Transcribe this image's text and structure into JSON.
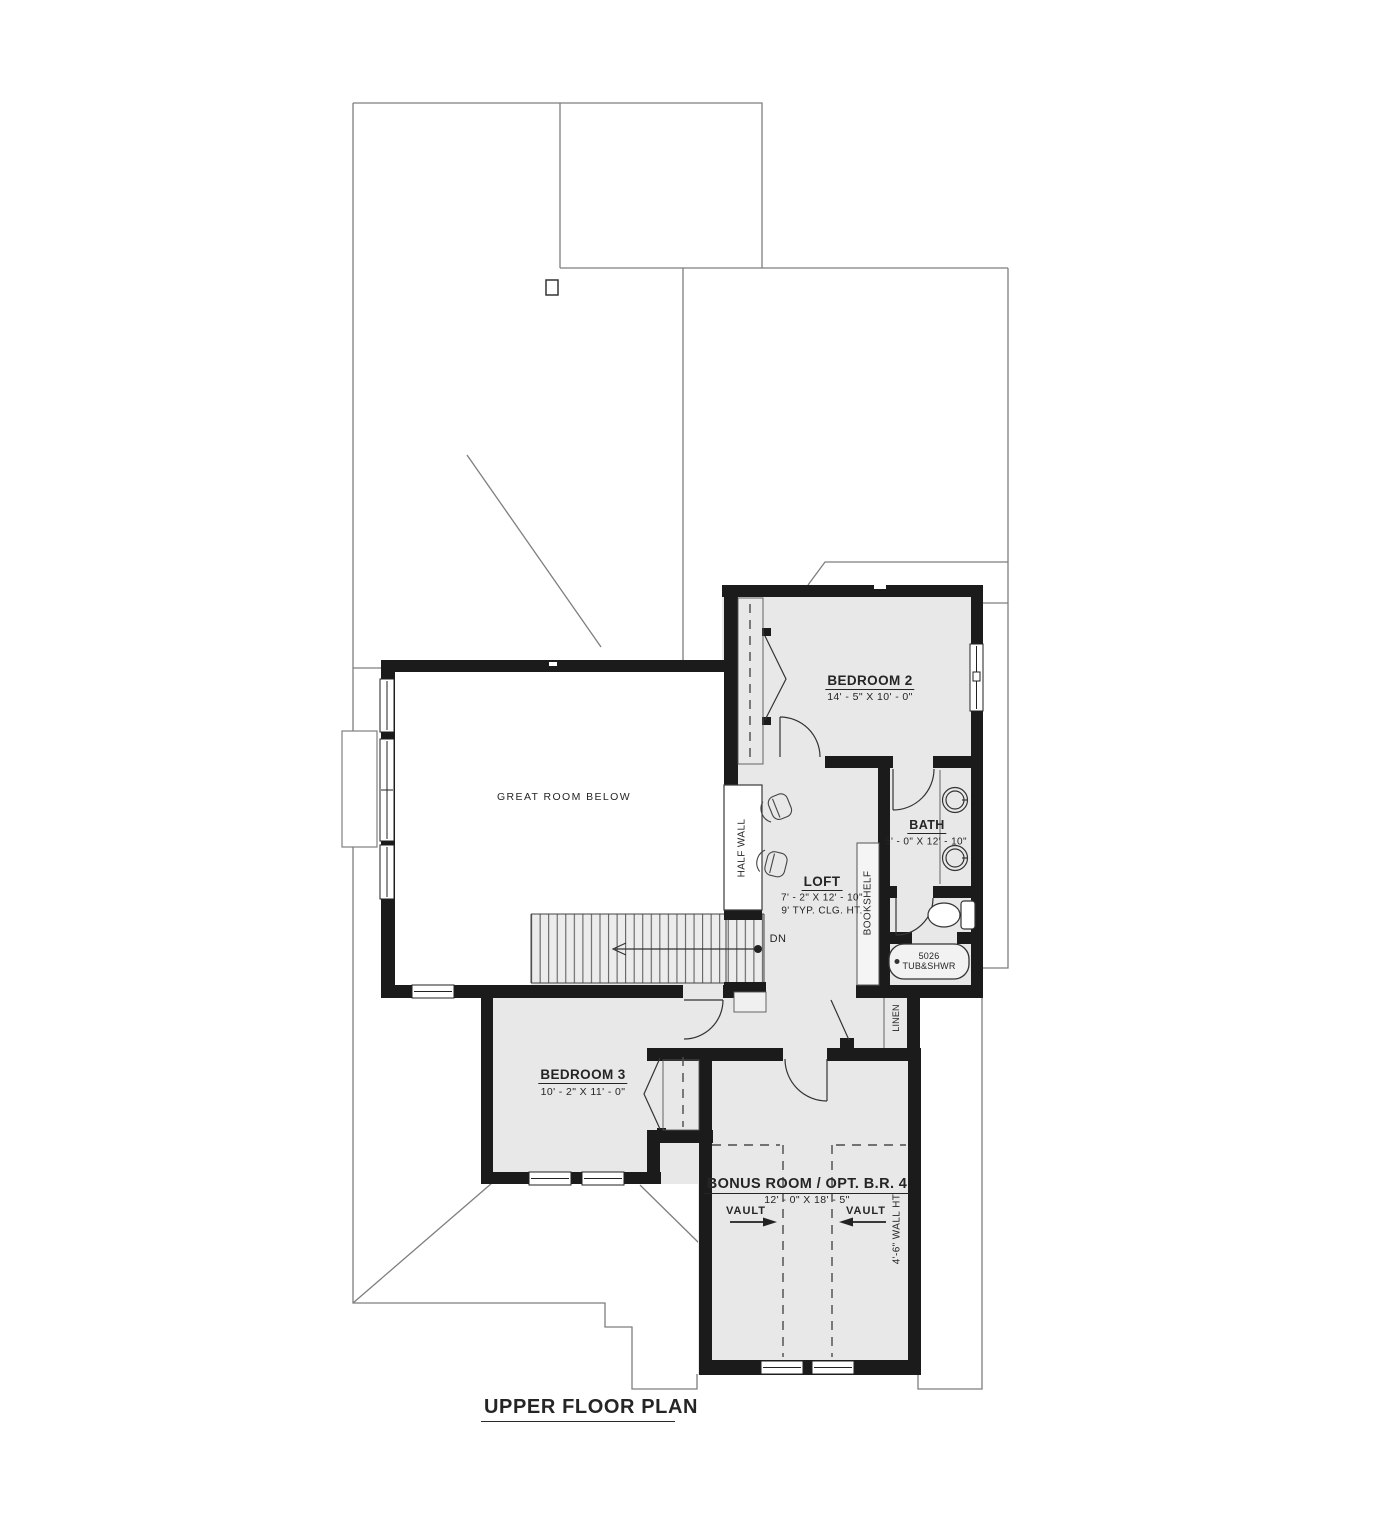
{
  "title": "UPPER FLOOR PLAN",
  "rooms": {
    "great_room": {
      "label": "GREAT ROOM BELOW"
    },
    "bedroom2": {
      "name": "BEDROOM 2",
      "dims": "14' - 5\" X 10' - 0\""
    },
    "bath": {
      "name": "BATH",
      "dims": "5' - 0\" X 12' - 10\""
    },
    "loft": {
      "name": "LOFT",
      "dims": "7' - 2\" X 12' - 10\"",
      "ceiling_note": "9' TYP. CLG. HT."
    },
    "bedroom3": {
      "name": "BEDROOM 3",
      "dims": "10' - 2\" X 11' - 0\""
    },
    "bonus_room": {
      "name": "BONUS ROOM / OPT. B.R. 4",
      "dims": "12' - 0\" X 18' - 5\"",
      "vault_left": "VAULT",
      "vault_right": "VAULT",
      "wall_height_note": "4'-6\" WALL HT."
    }
  },
  "annotations": {
    "half_wall": "HALF WALL",
    "bookshelf": "BOOKSHELF",
    "linen": "LINEN",
    "down": "DN",
    "tub_model": "5026",
    "tub_type": "TUB&SHWR"
  },
  "colors": {
    "wall": "#1b1b1b",
    "room_fill": "#e8e8e8",
    "roof_line": "#7e7e7e",
    "great_room_fill": "#ffffff"
  }
}
